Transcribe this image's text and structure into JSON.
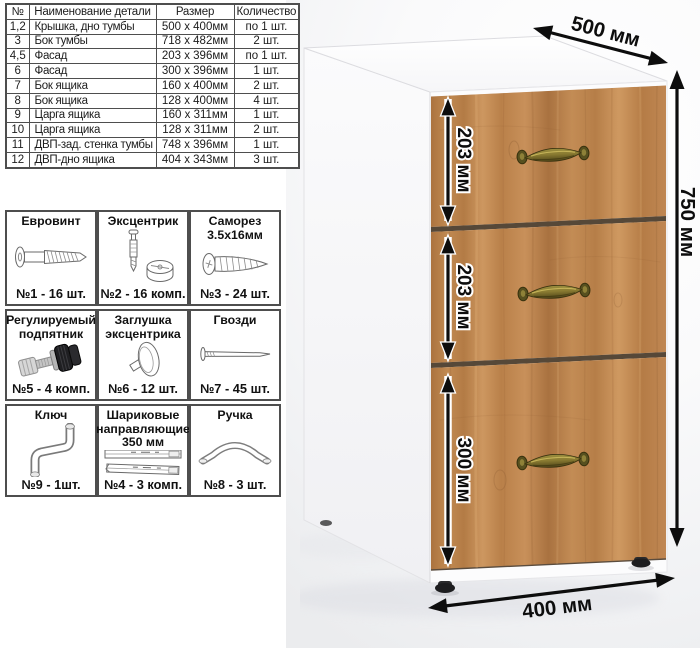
{
  "parts_table": {
    "headers": [
      "№",
      "Наименование детали",
      "Размер",
      "Количество"
    ],
    "rows": [
      {
        "num": "1,2",
        "name": "Крышка, дно тумбы",
        "size": "500 x 400мм",
        "qty": "по 1 шт."
      },
      {
        "num": "3",
        "name": "Бок тумбы",
        "size": "718 x 482мм",
        "qty": "2 шт."
      },
      {
        "num": "4,5",
        "name": "Фасад",
        "size": "203 x 396мм",
        "qty": "по 1 шт."
      },
      {
        "num": "6",
        "name": "Фасад",
        "size": "300 x 396мм",
        "qty": "1 шт."
      },
      {
        "num": "7",
        "name": "Бок ящика",
        "size": "160 x 400мм",
        "qty": "2 шт."
      },
      {
        "num": "8",
        "name": "Бок ящика",
        "size": "128 x 400мм",
        "qty": "4 шт."
      },
      {
        "num": "9",
        "name": "Царга ящика",
        "size": "160 x 311мм",
        "qty": "1 шт."
      },
      {
        "num": "10",
        "name": "Царга ящика",
        "size": "128 x 311мм",
        "qty": "2 шт."
      },
      {
        "num": "11",
        "name": "ДВП-зад. стенка тумбы",
        "size": "748 x 396мм",
        "qty": "1 шт."
      },
      {
        "num": "12",
        "name": "ДВП-дно ящика",
        "size": "404 x 343мм",
        "qty": "3 шт."
      }
    ]
  },
  "hardware": {
    "items": [
      {
        "title": "Евровинт",
        "count": "№1 - 16 шт.",
        "icon": "euroscrew-icon"
      },
      {
        "title": "Эксцентрик",
        "count": "№2 - 16 комп.",
        "icon": "cam-lock-icon"
      },
      {
        "title": "Саморез 3.5х16мм",
        "count": "№3 - 24 шт.",
        "icon": "self-tapping-screw-icon"
      },
      {
        "title": "Регулируемый подпятник",
        "count": "№5 - 4 комп.",
        "icon": "adjustable-foot-icon"
      },
      {
        "title": "Заглушка эксцентрика",
        "count": "№6 - 12 шт.",
        "icon": "cam-cap-icon"
      },
      {
        "title": "Гвозди",
        "count": "№7 - 45 шт.",
        "icon": "nail-icon"
      },
      {
        "title": "Ключ",
        "count": "№9 - 1шт.",
        "icon": "hex-key-icon"
      },
      {
        "title": "Шариковые направляющие 350 мм",
        "count": "№4 - 3 комп.",
        "icon": "drawer-slides-icon"
      },
      {
        "title": "Ручка",
        "count": "№8 - 3 шт.",
        "icon": "handle-icon"
      }
    ]
  },
  "dimensions": {
    "width_top": "500 мм",
    "height": "750 мм",
    "width_bottom": "400 мм",
    "drawer1": "203 мм",
    "drawer2": "203 мм",
    "drawer3": "300 мм"
  },
  "colors": {
    "wood_base": "#c08a52",
    "handle_brass": "#8b7c32",
    "dimension_text": "#0d0d0d",
    "table_border": "#4e4e4e"
  }
}
